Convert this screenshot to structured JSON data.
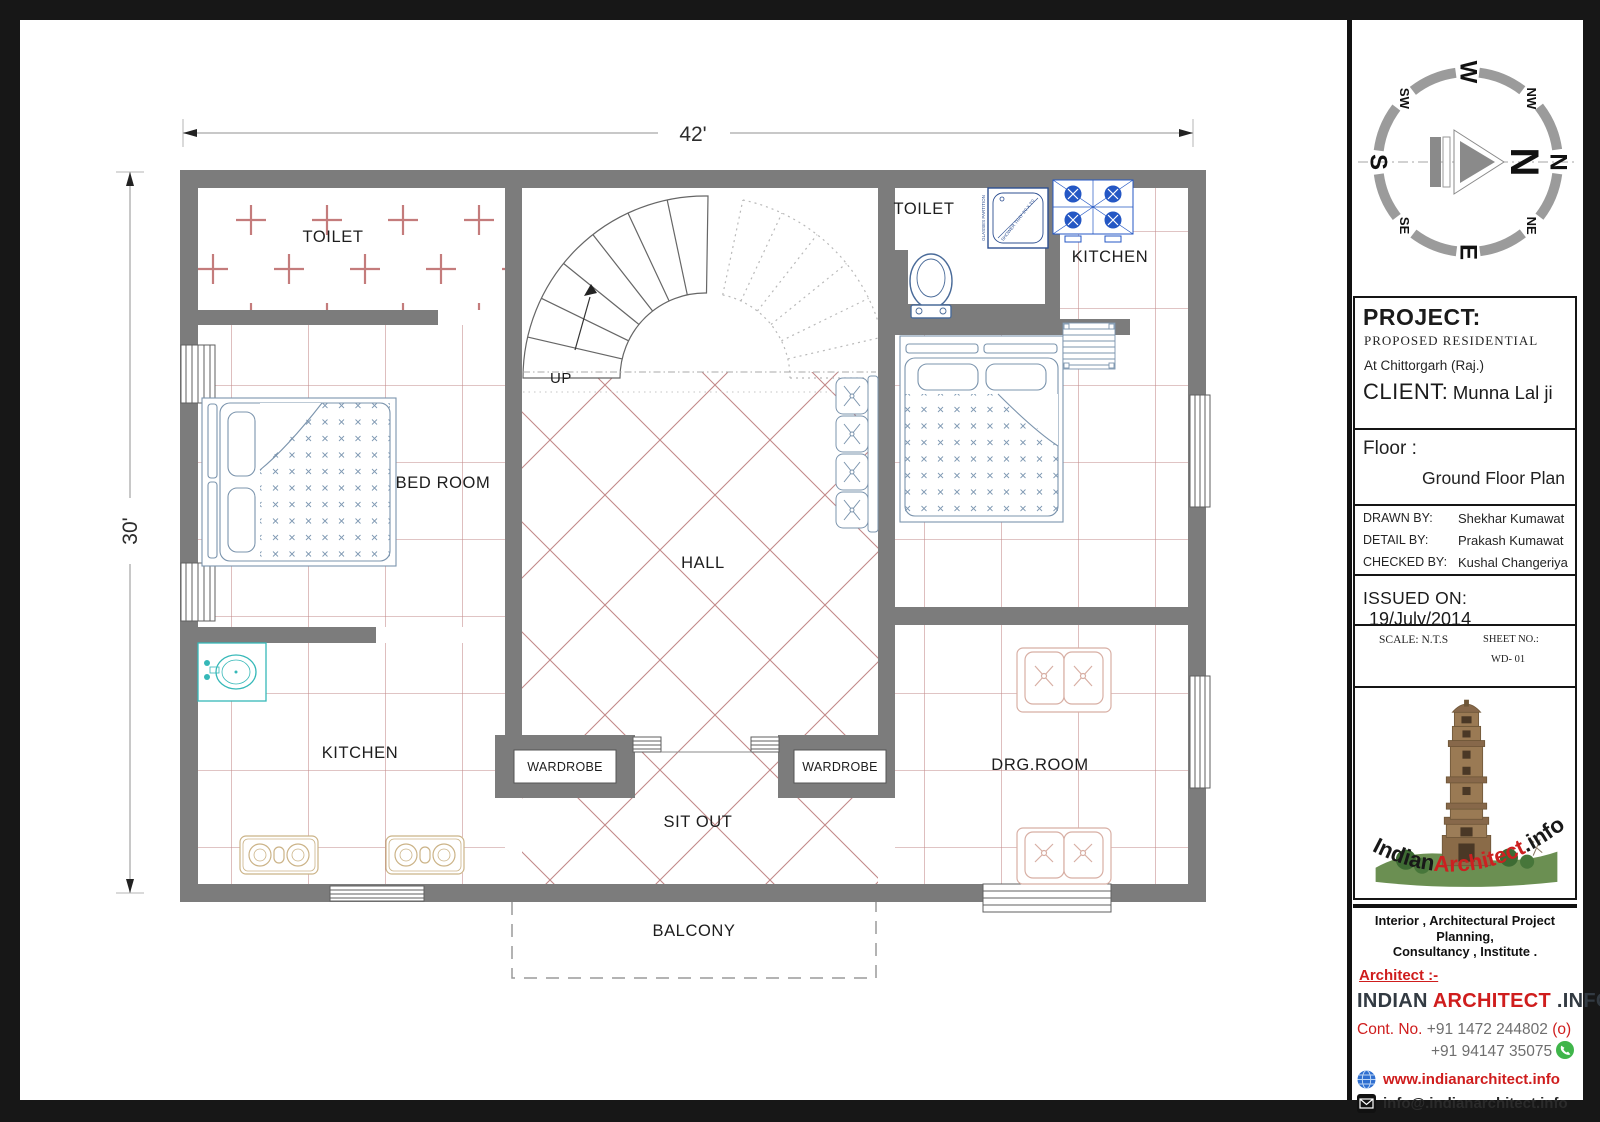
{
  "plan": {
    "dimensions": {
      "width_label": "42'",
      "height_label": "30'"
    },
    "labels": {
      "toilet_left": "TOILET",
      "bedroom_left": "BED ROOM",
      "kitchen_left": "KITCHEN",
      "hall": "HALL",
      "up": "UP",
      "wardrobe_left": "WARDROBE",
      "wardrobe_right": "WARDROBE",
      "sit_out": "SIT OUT",
      "balcony": "BALCONY",
      "toilet_right": "TOILET",
      "kitchen_right": "KITCHEN",
      "drg_room": "DRG.ROOM",
      "shower_tray": "SHOWER TRAY 3'0 X 3'0",
      "glass_partition": "GLASSES PARTITION"
    },
    "colors": {
      "wall": "#7c7c7c",
      "tile_line": "#c28989",
      "fixture_blue": "#7b94ad",
      "stove_blue": "#2457c4",
      "basin_cyan": "#35b8b8",
      "hob_tan": "#cbb387",
      "drg_sofa": "#d8afa4",
      "dim_line": "#b5b5b5"
    }
  },
  "compass": {
    "cardinals": {
      "n": "N",
      "e": "E",
      "s": "S",
      "w": "W"
    },
    "diagonals": {
      "nw": "NW",
      "ne": "NE",
      "sw": "SW",
      "se": "SE"
    },
    "needle_label": "N"
  },
  "title_block": {
    "project": {
      "heading": "PROJECT:",
      "type": "PROPOSED  RESIDENTIAL",
      "location": "At  Chittorgarh (Raj.)",
      "client_label": "CLIENT:",
      "client_name": "Munna Lal ji"
    },
    "floor": {
      "label": "Floor :",
      "value": "Ground Floor Plan"
    },
    "credits": [
      {
        "label": "DRAWN BY:",
        "value": "Shekhar Kumawat"
      },
      {
        "label": "DETAIL BY:",
        "value": "Prakash Kumawat"
      },
      {
        "label": "CHECKED BY:",
        "value": "Kushal Changeriya"
      }
    ],
    "issued": {
      "label": "ISSUED ON:",
      "value": "19/July/2014"
    },
    "scale": {
      "label": "SCALE: N.T.S"
    },
    "sheet": {
      "label": "SHEET NO.:",
      "value": "WD- 01"
    }
  },
  "logo": {
    "brand_indian": "Indian",
    "brand_architect": "Architect",
    "brand_info": ".info"
  },
  "footer": {
    "services_line1": "Interior , Architectural Project Planning,",
    "services_line2": "Consultancy , Institute .",
    "architect_label": "Architect :-",
    "brand_part1": "INDIAN",
    "brand_part2": "ARCHITECT",
    "brand_part3": ".INFO",
    "contact_label": "Cont. No.",
    "phone1": "+91 1472 244802",
    "phone1_note": "(o)",
    "phone2": "+91 94147 35075",
    "website": "www.indianarchitect.info",
    "email": "info@.indianarchitect.info"
  }
}
